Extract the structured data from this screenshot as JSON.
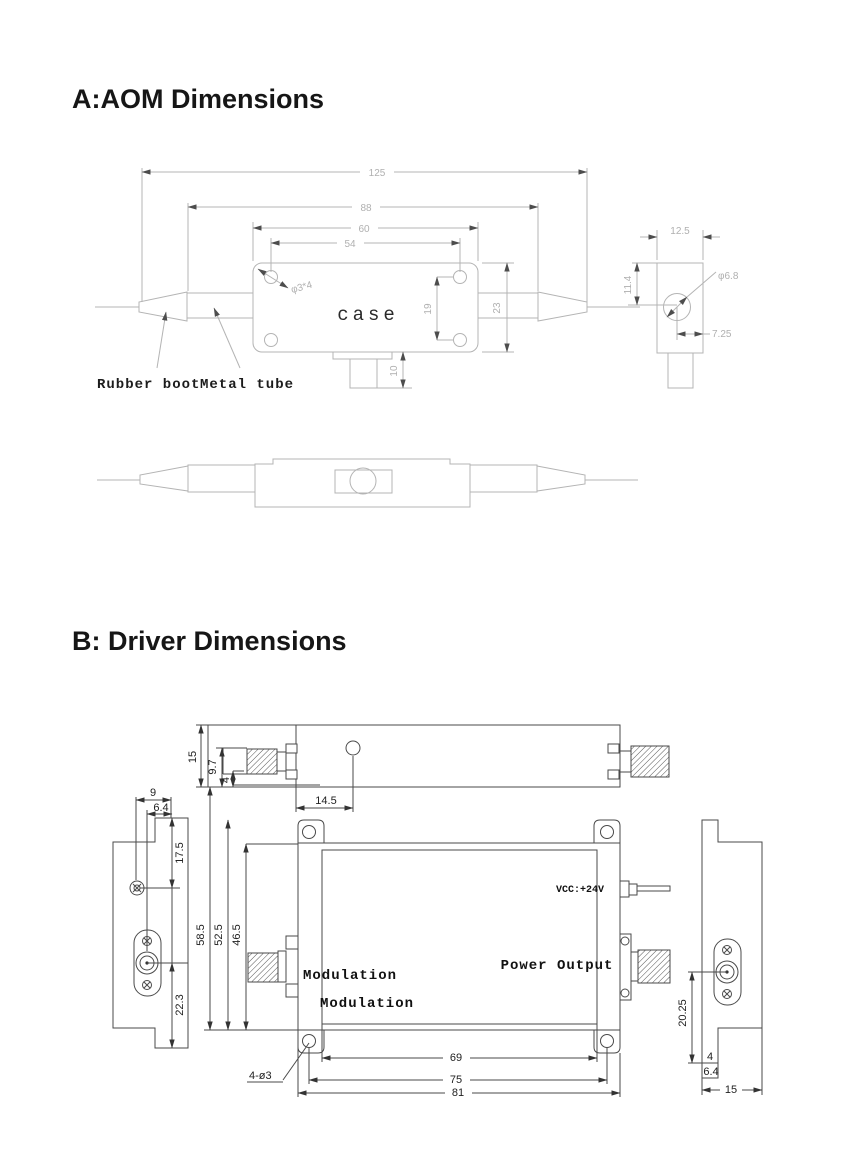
{
  "page": {
    "background": "#ffffff"
  },
  "sections": {
    "aom": {
      "title": "A:AOM Dimensions",
      "labels": {
        "case": "case",
        "rubber_boot": "Rubber boot",
        "metal_tube": "Metal tube",
        "hole_callout": "φ3*4"
      },
      "dims": {
        "overall": "125",
        "tube_span": "88",
        "case_len": "60",
        "hole_span": "54",
        "hole_vspan": "19",
        "case_h": "23",
        "tab_h": "10",
        "side_w": "12.5",
        "side_h": "11.4",
        "side_hole": "φ6.8",
        "side_off": "7.25"
      }
    },
    "driver": {
      "title": "B: Driver Dimensions",
      "labels": {
        "mod1": "Modulation",
        "mod2": "Modulation",
        "power": "Power Output",
        "vcc": "VCC:+24V",
        "holes": "4-ø3"
      },
      "dims": {
        "top_h": "15",
        "top_conn": "9.7",
        "top_step": "4",
        "top_hole": "14.5",
        "l_screw": "9",
        "l_conn": "6.4",
        "l_top": "17.5",
        "l_bot": "22.3",
        "v1": "58.5",
        "v2": "52.5",
        "v3": "46.5",
        "w_in": "69",
        "w_holes": "75",
        "w_out": "81",
        "r_conn": "20.25",
        "r_s1": "4",
        "r_s2": "6.4",
        "r_w": "15"
      }
    }
  }
}
